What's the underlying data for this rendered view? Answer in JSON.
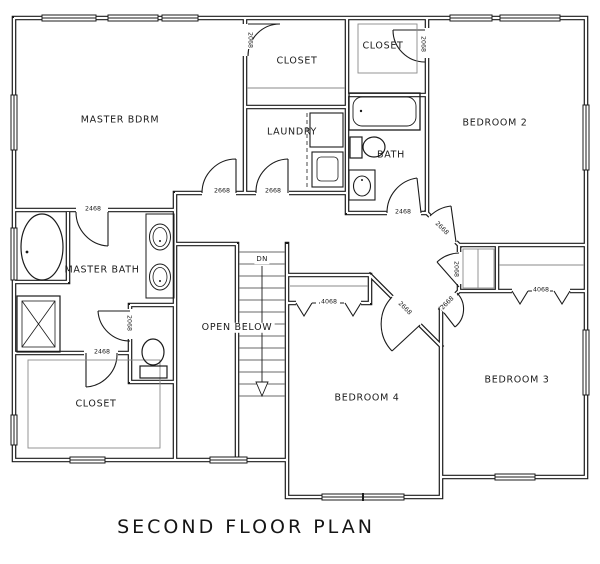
{
  "title": "SECOND FLOOR PLAN",
  "rooms": {
    "master_bdrm": "MASTER BDRM",
    "master_closet": "CLOSET",
    "closet2": "CLOSET",
    "laundry": "LAUNDRY",
    "bath": "BATH",
    "bedroom2": "BEDROOM 2",
    "master_bath": "MASTER BATH",
    "open_below": "OPEN BELOW",
    "stairs_dn": "DN",
    "walkin_closet": "CLOSET",
    "bedroom4": "BEDROOM 4",
    "bedroom3": "BEDROOM 3"
  },
  "door_labels": {
    "master_closet_door": "2068",
    "closet2_door": "2068",
    "master_bdrm_door": "2668",
    "laundry_door": "2668",
    "master_bath_door": "2468",
    "bath_door": "2468",
    "bedroom2_door": "2668",
    "linen_closet_door": "2068",
    "bedroom3_door": "2668",
    "bedroom4_door": "2668",
    "bedroom4_closet_bifold": "4068",
    "bedroom3_closet_bifold": "4068",
    "walkin_closet_door": "2468",
    "toilet_room_door": "2068"
  },
  "colors": {
    "line": "#1b1b1b",
    "background": "#ffffff"
  }
}
